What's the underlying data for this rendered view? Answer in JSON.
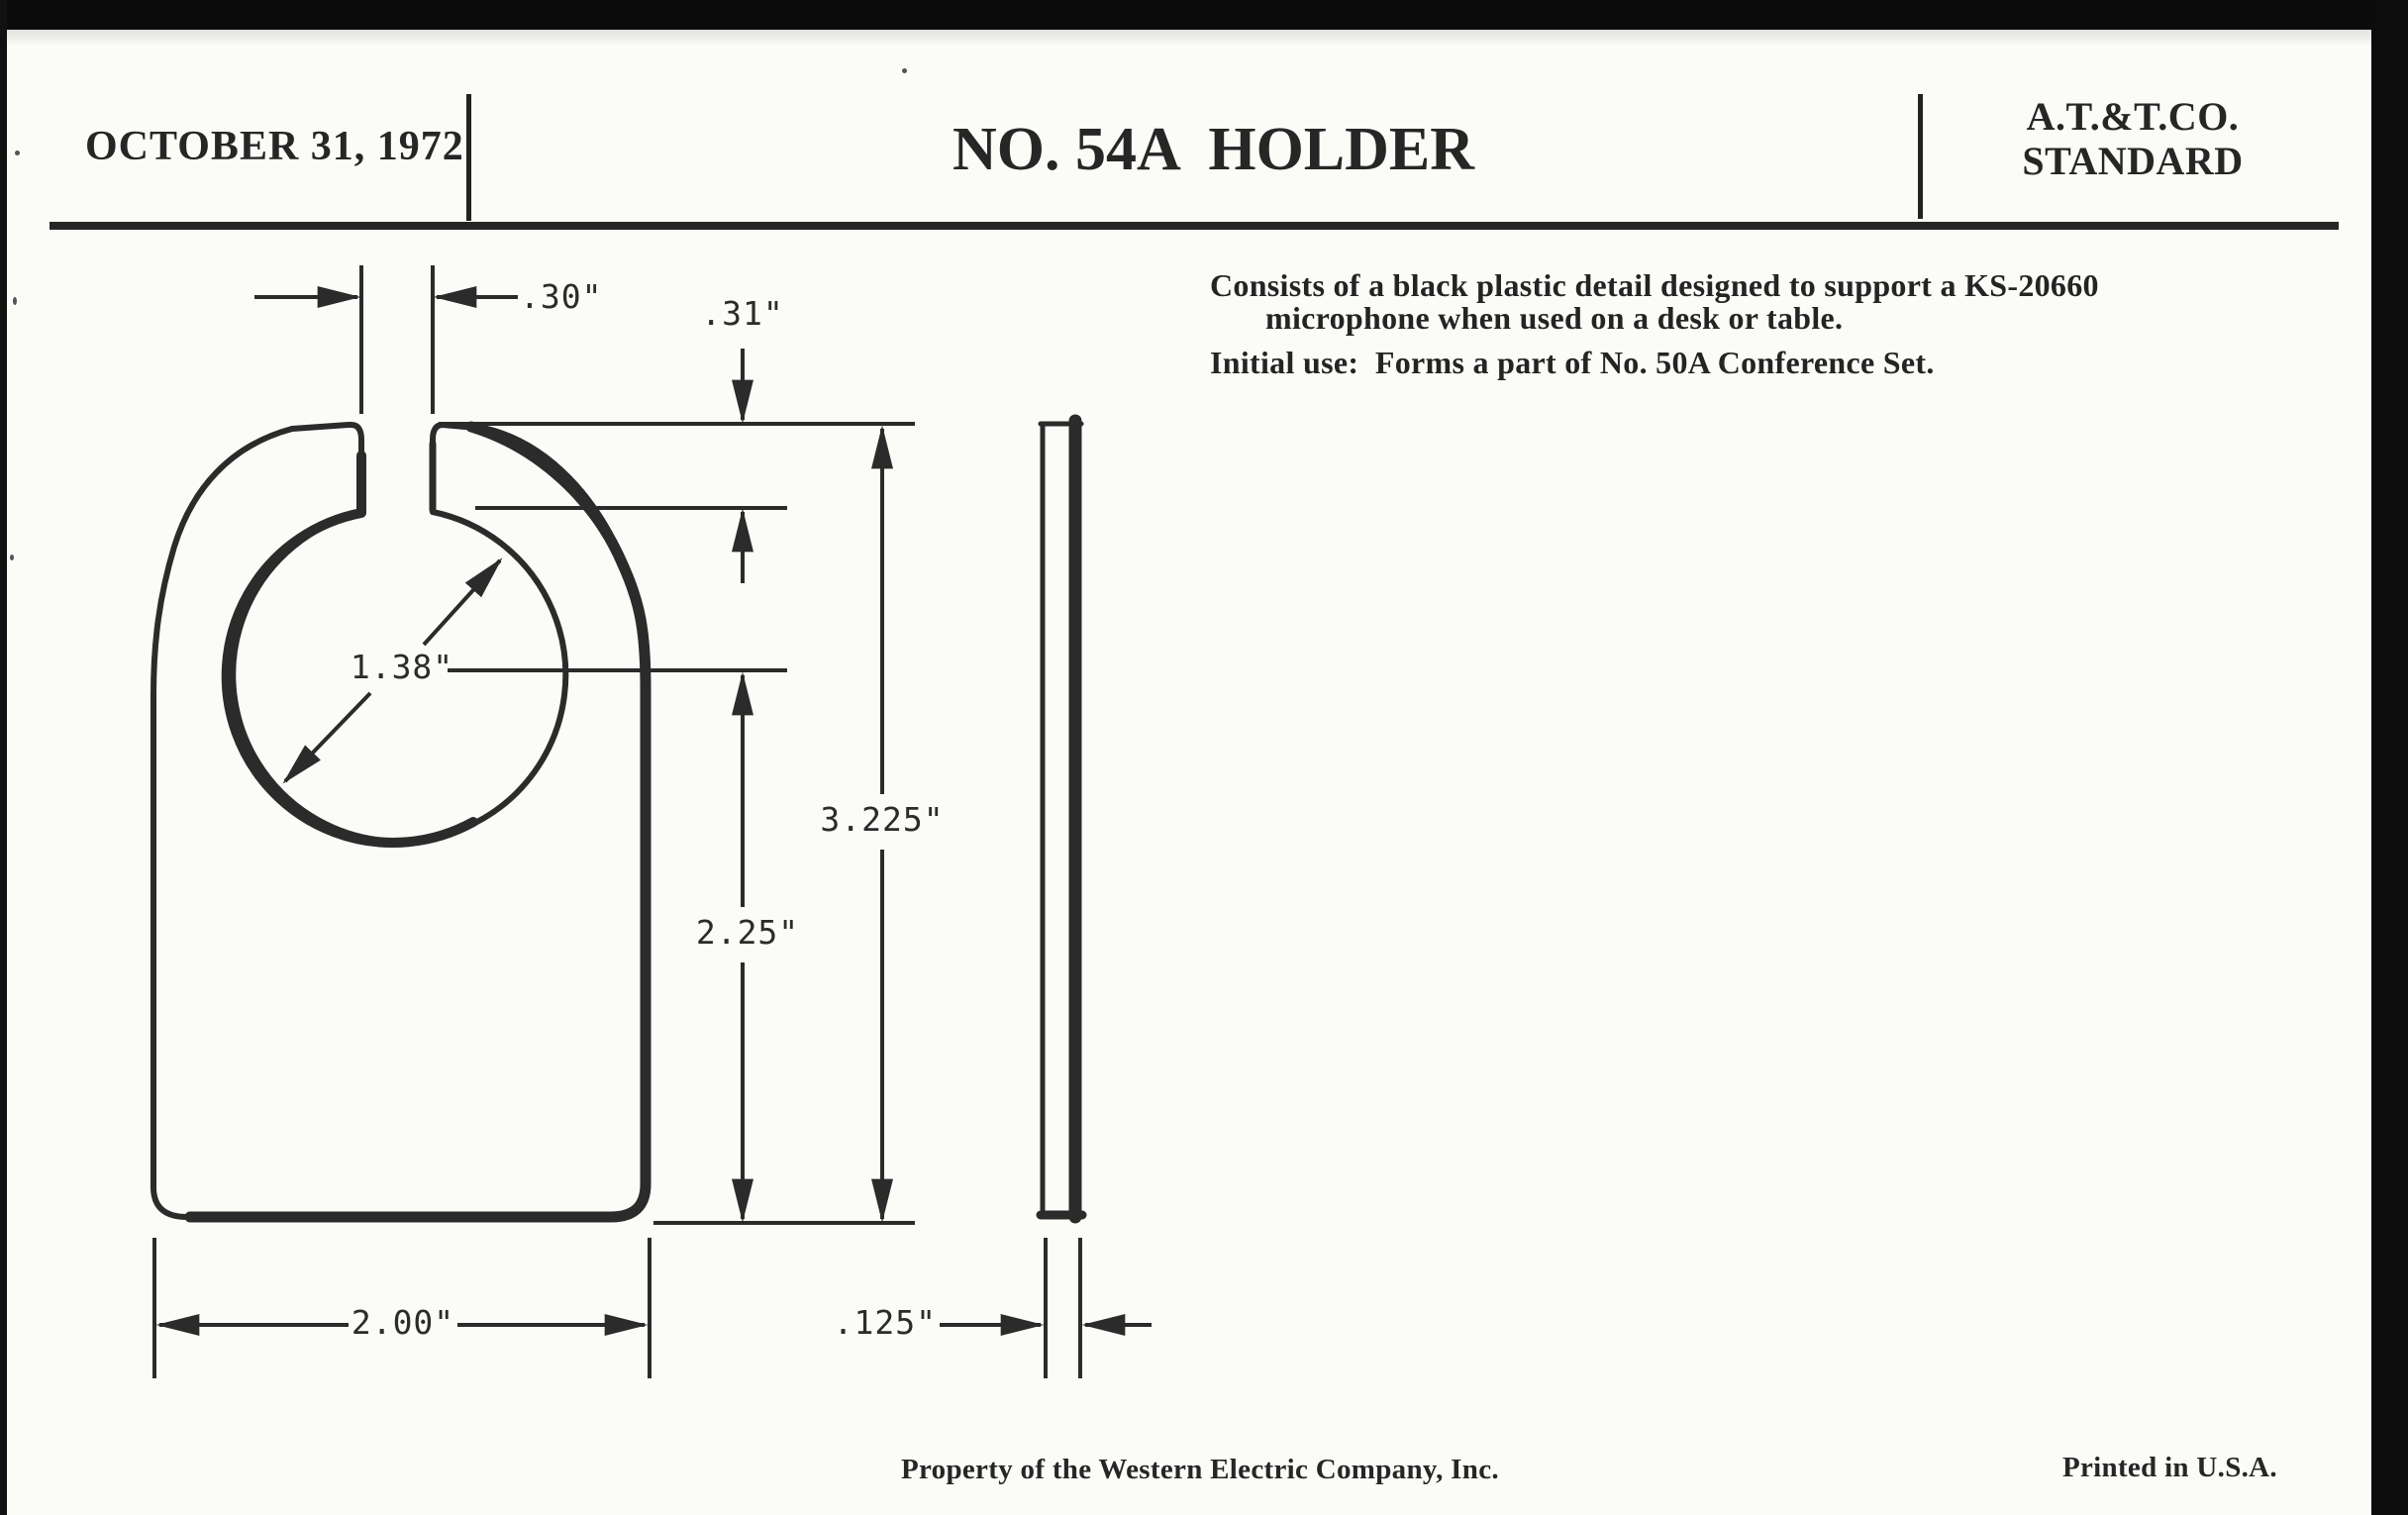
{
  "header": {
    "date": "OCTOBER 31, 1972",
    "title": "NO. 54A  HOLDER",
    "org_line1": "A.T.&T.CO.",
    "org_line2": "STANDARD"
  },
  "description": {
    "line1": "Consists of a black plastic detail designed to support a KS-20660",
    "line2": "microphone when used on a desk or table.",
    "line3": "Initial use:  Forms a part of No. 50A Conference Set."
  },
  "drawing": {
    "dimensions": {
      "slot_width": ".30\"",
      "slot_depth": ".31\"",
      "hole_diameter": "1.38\"",
      "hole_center_to_bottom": "2.25\"",
      "overall_height": "3.225\"",
      "overall_width": "2.00\"",
      "thickness": ".125\""
    }
  },
  "footer": {
    "property": "Property of the Western Electric Company, Inc.",
    "printed": "Printed in U.S.A."
  },
  "colors": {
    "paper": "#fbfbf8",
    "ink": "#262626",
    "scan_border": "#0b0b0b"
  }
}
